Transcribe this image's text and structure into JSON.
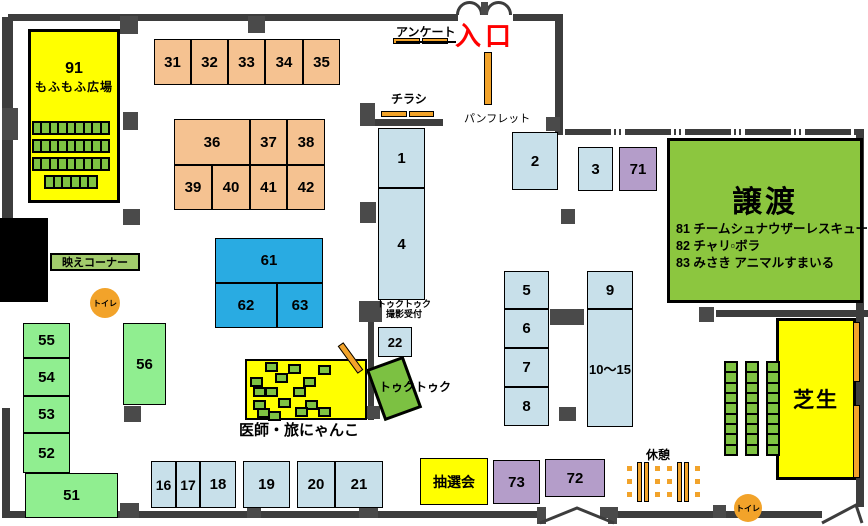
{
  "colors": {
    "wall": "#3d3d3d",
    "pillar": "#4a4a4a",
    "black": "#000000",
    "peach": "#F5C291",
    "lightblue": "#C8E0EA",
    "blue": "#29ABE2",
    "green": "#90EE90",
    "purple": "#B49DC9",
    "yellow": "#FFFF00",
    "adoption_green": "#8CC63F",
    "tuk_green": "#7CC142",
    "bae_green": "#A2CB6C",
    "seat_green": "#7FC342",
    "orange": "#F2A32A",
    "entrance_red": "#FF0000"
  },
  "entrance": {
    "label": "入口"
  },
  "signs": {
    "survey": "アンケート",
    "flyer": "チラシ",
    "pamphlet": "パンフレット",
    "tuktuk_reception_line1": "トゥクトゥク",
    "tuktuk_reception_line2": "撮影受付",
    "tuktuk": "トゥクトゥク",
    "rest": "休憩",
    "toilet": "トイレ",
    "photo_corner": "映えコーナー",
    "lottery": "抽選会"
  },
  "areas": {
    "mofu": {
      "number": "91",
      "label": "もふもふ広場"
    },
    "adoption": {
      "title": "譲渡",
      "lines": [
        "81 チームシュナウザーレスキュー",
        "82 チャリ▫ボラ",
        "83 みさき アニマルすまいる"
      ]
    },
    "lawn": {
      "label": "芝生"
    },
    "vet": {
      "label": "医師・旅にゃんこ"
    }
  },
  "booths": [
    {
      "id": "31",
      "label": "31",
      "x": 154,
      "y": 39,
      "w": 37,
      "h": 46,
      "fill": "peach"
    },
    {
      "id": "32",
      "label": "32",
      "x": 191,
      "y": 39,
      "w": 37,
      "h": 46,
      "fill": "peach"
    },
    {
      "id": "33",
      "label": "33",
      "x": 228,
      "y": 39,
      "w": 37,
      "h": 46,
      "fill": "peach"
    },
    {
      "id": "34",
      "label": "34",
      "x": 265,
      "y": 39,
      "w": 38,
      "h": 46,
      "fill": "peach"
    },
    {
      "id": "35",
      "label": "35",
      "x": 303,
      "y": 39,
      "w": 37,
      "h": 46,
      "fill": "peach"
    },
    {
      "id": "36",
      "label": "36",
      "x": 174,
      "y": 119,
      "w": 76,
      "h": 46,
      "fill": "peach"
    },
    {
      "id": "37",
      "label": "37",
      "x": 250,
      "y": 119,
      "w": 37,
      "h": 46,
      "fill": "peach"
    },
    {
      "id": "38",
      "label": "38",
      "x": 287,
      "y": 119,
      "w": 38,
      "h": 46,
      "fill": "peach"
    },
    {
      "id": "39",
      "label": "39",
      "x": 174,
      "y": 165,
      "w": 38,
      "h": 45,
      "fill": "peach"
    },
    {
      "id": "40",
      "label": "40",
      "x": 212,
      "y": 165,
      "w": 38,
      "h": 45,
      "fill": "peach"
    },
    {
      "id": "41",
      "label": "41",
      "x": 250,
      "y": 165,
      "w": 37,
      "h": 45,
      "fill": "peach"
    },
    {
      "id": "42",
      "label": "42",
      "x": 287,
      "y": 165,
      "w": 38,
      "h": 45,
      "fill": "peach"
    },
    {
      "id": "1",
      "label": "1",
      "x": 378,
      "y": 128,
      "w": 47,
      "h": 60,
      "fill": "lightblue"
    },
    {
      "id": "4",
      "label": "4",
      "x": 378,
      "y": 188,
      "w": 47,
      "h": 112,
      "fill": "lightblue"
    },
    {
      "id": "2",
      "label": "2",
      "x": 512,
      "y": 132,
      "w": 46,
      "h": 58,
      "fill": "lightblue"
    },
    {
      "id": "3",
      "label": "3",
      "x": 578,
      "y": 147,
      "w": 35,
      "h": 44,
      "fill": "lightblue"
    },
    {
      "id": "71",
      "label": "71",
      "x": 619,
      "y": 147,
      "w": 38,
      "h": 44,
      "fill": "purple"
    },
    {
      "id": "5",
      "label": "5",
      "x": 504,
      "y": 271,
      "w": 45,
      "h": 38,
      "fill": "lightblue"
    },
    {
      "id": "6",
      "label": "6",
      "x": 504,
      "y": 309,
      "w": 45,
      "h": 39,
      "fill": "lightblue"
    },
    {
      "id": "7",
      "label": "7",
      "x": 504,
      "y": 348,
      "w": 45,
      "h": 39,
      "fill": "lightblue"
    },
    {
      "id": "8",
      "label": "8",
      "x": 504,
      "y": 387,
      "w": 45,
      "h": 39,
      "fill": "lightblue"
    },
    {
      "id": "9",
      "label": "9",
      "x": 587,
      "y": 271,
      "w": 46,
      "h": 38,
      "fill": "lightblue"
    },
    {
      "id": "10-15",
      "label": "10～15",
      "x": 587,
      "y": 309,
      "w": 46,
      "h": 118,
      "fill": "lightblue",
      "fs": 13
    },
    {
      "id": "22",
      "label": "22",
      "x": 378,
      "y": 327,
      "w": 34,
      "h": 30,
      "fill": "lightblue",
      "fs": 13
    },
    {
      "id": "61",
      "label": "61",
      "x": 215,
      "y": 238,
      "w": 108,
      "h": 45,
      "fill": "blue"
    },
    {
      "id": "62",
      "label": "62",
      "x": 215,
      "y": 283,
      "w": 62,
      "h": 45,
      "fill": "blue"
    },
    {
      "id": "63",
      "label": "63",
      "x": 277,
      "y": 283,
      "w": 46,
      "h": 45,
      "fill": "blue"
    },
    {
      "id": "55",
      "label": "55",
      "x": 23,
      "y": 323,
      "w": 47,
      "h": 35,
      "fill": "green"
    },
    {
      "id": "54",
      "label": "54",
      "x": 23,
      "y": 358,
      "w": 47,
      "h": 38,
      "fill": "green"
    },
    {
      "id": "53",
      "label": "53",
      "x": 23,
      "y": 396,
      "w": 47,
      "h": 37,
      "fill": "green"
    },
    {
      "id": "52",
      "label": "52",
      "x": 23,
      "y": 433,
      "w": 47,
      "h": 40,
      "fill": "green"
    },
    {
      "id": "51",
      "label": "51",
      "x": 25,
      "y": 473,
      "w": 93,
      "h": 45,
      "fill": "green"
    },
    {
      "id": "56",
      "label": "56",
      "x": 123,
      "y": 323,
      "w": 43,
      "h": 82,
      "fill": "green"
    },
    {
      "id": "16",
      "label": "16",
      "x": 151,
      "y": 461,
      "w": 25,
      "h": 47,
      "fill": "lightblue",
      "fs": 14
    },
    {
      "id": "17",
      "label": "17",
      "x": 176,
      "y": 461,
      "w": 24,
      "h": 47,
      "fill": "lightblue",
      "fs": 14
    },
    {
      "id": "18",
      "label": "18",
      "x": 200,
      "y": 461,
      "w": 36,
      "h": 47,
      "fill": "lightblue"
    },
    {
      "id": "19",
      "label": "19",
      "x": 243,
      "y": 461,
      "w": 47,
      "h": 47,
      "fill": "lightblue"
    },
    {
      "id": "20",
      "label": "20",
      "x": 297,
      "y": 461,
      "w": 38,
      "h": 47,
      "fill": "lightblue"
    },
    {
      "id": "21",
      "label": "21",
      "x": 335,
      "y": 461,
      "w": 48,
      "h": 47,
      "fill": "lightblue"
    },
    {
      "id": "73",
      "label": "73",
      "x": 493,
      "y": 460,
      "w": 47,
      "h": 44,
      "fill": "purple"
    },
    {
      "id": "72",
      "label": "72",
      "x": 545,
      "y": 459,
      "w": 60,
      "h": 38,
      "fill": "purple"
    }
  ],
  "walls": [
    {
      "x": 8,
      "y": 14,
      "w": 450,
      "h": 7
    },
    {
      "x": 513,
      "y": 14,
      "w": 49,
      "h": 7
    },
    {
      "x": 555,
      "y": 14,
      "w": 8,
      "h": 121
    },
    {
      "x": 565,
      "y": 129,
      "w": 291,
      "h": 6,
      "dashed": true
    },
    {
      "x": 856,
      "y": 129,
      "w": 8,
      "h": 378
    },
    {
      "x": 8,
      "y": 511,
      "w": 529,
      "h": 7
    },
    {
      "x": 617,
      "y": 511,
      "w": 205,
      "h": 7
    },
    {
      "x": 2,
      "y": 17,
      "w": 11,
      "h": 201
    },
    {
      "x": 2,
      "y": 408,
      "w": 8,
      "h": 110
    },
    {
      "x": 372,
      "y": 119,
      "w": 71,
      "h": 7
    },
    {
      "x": 368,
      "y": 312,
      "w": 6,
      "h": 108
    },
    {
      "x": 716,
      "y": 310,
      "w": 152,
      "h": 7
    },
    {
      "x": 484,
      "y": 76,
      "w": 8,
      "h": 3
    },
    {
      "x": 0,
      "y": 218,
      "w": 48,
      "h": 84,
      "fill": "black"
    }
  ],
  "pillars": [
    {
      "x": 120,
      "y": 16,
      "w": 18,
      "h": 18
    },
    {
      "x": 248,
      "y": 16,
      "w": 17,
      "h": 17
    },
    {
      "x": 2,
      "y": 108,
      "w": 16,
      "h": 32
    },
    {
      "x": 123,
      "y": 112,
      "w": 15,
      "h": 18
    },
    {
      "x": 123,
      "y": 209,
      "w": 17,
      "h": 16
    },
    {
      "x": 360,
      "y": 103,
      "w": 15,
      "h": 23
    },
    {
      "x": 360,
      "y": 202,
      "w": 16,
      "h": 21
    },
    {
      "x": 359,
      "y": 301,
      "w": 23,
      "h": 21
    },
    {
      "x": 546,
      "y": 117,
      "w": 14,
      "h": 14
    },
    {
      "x": 561,
      "y": 209,
      "w": 14,
      "h": 15
    },
    {
      "x": 550,
      "y": 309,
      "w": 34,
      "h": 16
    },
    {
      "x": 559,
      "y": 407,
      "w": 17,
      "h": 14
    },
    {
      "x": 124,
      "y": 406,
      "w": 17,
      "h": 16
    },
    {
      "x": 699,
      "y": 307,
      "w": 15,
      "h": 15
    },
    {
      "x": 362,
      "y": 406,
      "w": 18,
      "h": 13
    },
    {
      "x": 120,
      "y": 503,
      "w": 19,
      "h": 15
    },
    {
      "x": 247,
      "y": 502,
      "w": 14,
      "h": 16
    },
    {
      "x": 359,
      "y": 501,
      "w": 19,
      "h": 17
    },
    {
      "x": 600,
      "y": 507,
      "w": 18,
      "h": 11
    },
    {
      "x": 713,
      "y": 505,
      "w": 13,
      "h": 13
    },
    {
      "x": 537,
      "y": 507,
      "w": 9,
      "h": 17
    },
    {
      "x": 608,
      "y": 507,
      "w": 9,
      "h": 17
    },
    {
      "x": 481,
      "y": 2,
      "w": 7,
      "h": 13
    }
  ],
  "orange_bars": [
    {
      "x": 393,
      "y": 38,
      "w": 27,
      "h": 6
    },
    {
      "x": 422,
      "y": 38,
      "w": 26,
      "h": 6
    },
    {
      "x": 381,
      "y": 111,
      "w": 26,
      "h": 6
    },
    {
      "x": 409,
      "y": 111,
      "w": 25,
      "h": 6
    },
    {
      "x": 484,
      "y": 52,
      "w": 8,
      "h": 53
    },
    {
      "x": 853,
      "y": 322,
      "w": 7,
      "h": 60
    },
    {
      "x": 853,
      "y": 405,
      "w": 7,
      "h": 73
    },
    {
      "x": 347,
      "y": 341,
      "w": 7,
      "h": 34,
      "rot": -36
    }
  ],
  "toilets": [
    {
      "x": 90,
      "y": 288,
      "d": 30
    },
    {
      "x": 734,
      "y": 494,
      "d": 28
    }
  ],
  "seat_strips": [
    {
      "x": 32,
      "y": 121,
      "w": 78,
      "h": 14,
      "dir": "h",
      "n": 9
    },
    {
      "x": 32,
      "y": 139,
      "w": 78,
      "h": 14,
      "dir": "h",
      "n": 9
    },
    {
      "x": 32,
      "y": 157,
      "w": 78,
      "h": 14,
      "dir": "h",
      "n": 9
    },
    {
      "x": 44,
      "y": 175,
      "w": 54,
      "h": 14,
      "dir": "h",
      "n": 6
    },
    {
      "x": 724,
      "y": 361,
      "w": 14,
      "h": 95,
      "dir": "v",
      "n": 9
    },
    {
      "x": 745,
      "y": 361,
      "w": 14,
      "h": 95,
      "dir": "v",
      "n": 9
    },
    {
      "x": 766,
      "y": 361,
      "w": 14,
      "h": 95,
      "dir": "v",
      "n": 9
    }
  ],
  "vet_seats": [
    [
      20,
      3
    ],
    [
      43,
      5
    ],
    [
      73,
      6
    ],
    [
      30,
      14
    ],
    [
      5,
      18
    ],
    [
      58,
      18
    ],
    [
      8,
      28
    ],
    [
      20,
      28
    ],
    [
      48,
      28
    ],
    [
      33,
      39
    ],
    [
      8,
      41
    ],
    [
      60,
      41
    ],
    [
      12,
      49
    ],
    [
      23,
      52
    ],
    [
      50,
      48
    ],
    [
      73,
      48
    ]
  ],
  "rest_tables": [
    {
      "x": 637,
      "y": 462
    },
    {
      "x": 677,
      "y": 462
    }
  ]
}
